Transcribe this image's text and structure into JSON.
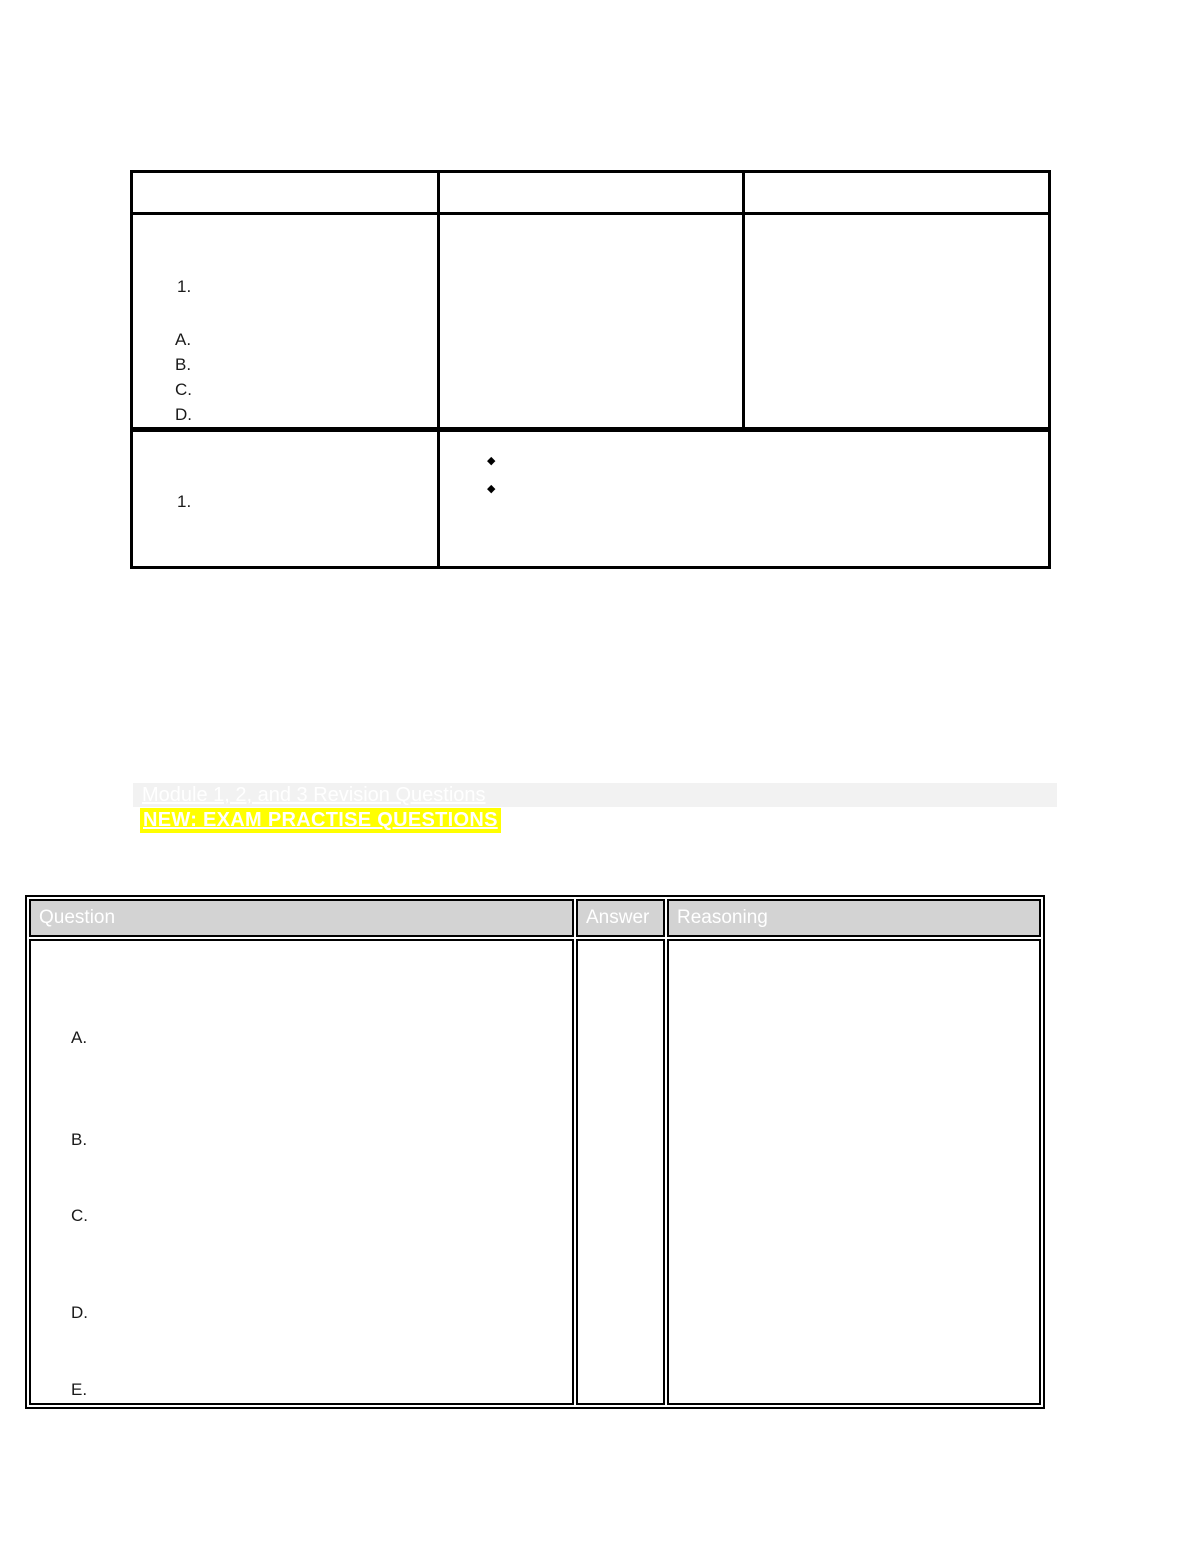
{
  "table1": {
    "row2": {
      "numbered_item": "1.",
      "options": [
        "A.",
        "B.",
        "C.",
        "D."
      ]
    },
    "row3": {
      "numbered_item": "1.",
      "bullet_glyph": "◆",
      "bullets": [
        "",
        ""
      ]
    }
  },
  "headings": {
    "module_line": "Module 1, 2, and 3 Revision Questions",
    "exam_line": "NEW: EXAM PRACTISE QUESTIONS"
  },
  "colors": {
    "highlight_yellow": "#ffff00",
    "bar_gray": "#f2f2f2",
    "table_header_gray": "#d3d3d3",
    "heading_text": "#ffffff",
    "border_black": "#000000"
  },
  "table2": {
    "headers": [
      "Question",
      "Answer",
      "Reasoning"
    ],
    "question_options": [
      "A.",
      "B.",
      "C.",
      "D.",
      "E."
    ]
  }
}
